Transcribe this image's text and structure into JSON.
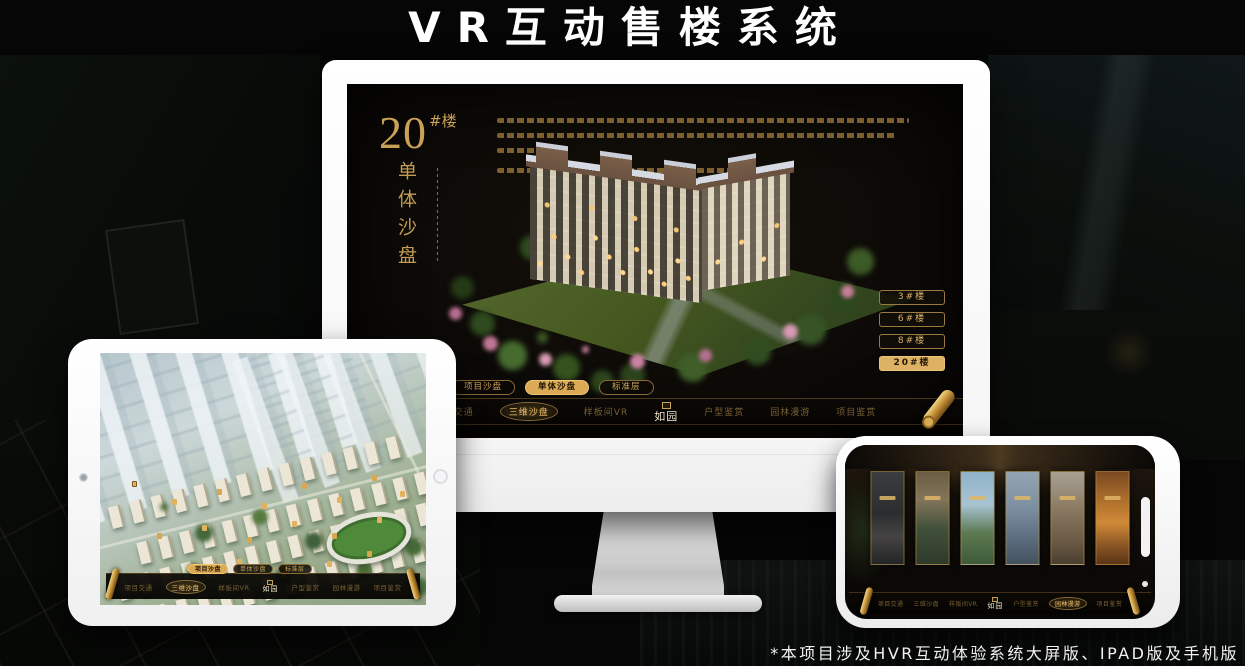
{
  "header": {
    "title": "VR互动售楼系统"
  },
  "footer": {
    "note": "*本项目涉及HVR互动体验系统大屏版、IPAD版及手机版"
  },
  "brand": {
    "logo": "如园"
  },
  "nav": {
    "items": [
      "项目交通",
      "三维沙盘",
      "样板间VR",
      "户型鉴赏",
      "园林漫游",
      "项目鉴赏"
    ]
  },
  "tabs": {
    "items": [
      "项目沙盘",
      "单体沙盘",
      "标准层"
    ]
  },
  "desktop": {
    "heading": {
      "number": "20",
      "suffix": "#楼",
      "vertical": "单体沙盘"
    },
    "floor_buttons": [
      "3#楼",
      "6#楼",
      "8#楼",
      "20#楼"
    ],
    "active_floor": "20#楼",
    "active_tab": "单体沙盘",
    "active_nav": "三维沙盘"
  },
  "tablet": {
    "active_tab": "项目沙盘",
    "active_nav": "三维沙盘"
  },
  "phone": {
    "active_nav": "园林漫游",
    "panel_count": 6
  },
  "colors": {
    "gold": "#c9a155",
    "gold_bright": "#ecc06b",
    "screen_bg": "#0c0a07",
    "page_bg": "#050605"
  }
}
